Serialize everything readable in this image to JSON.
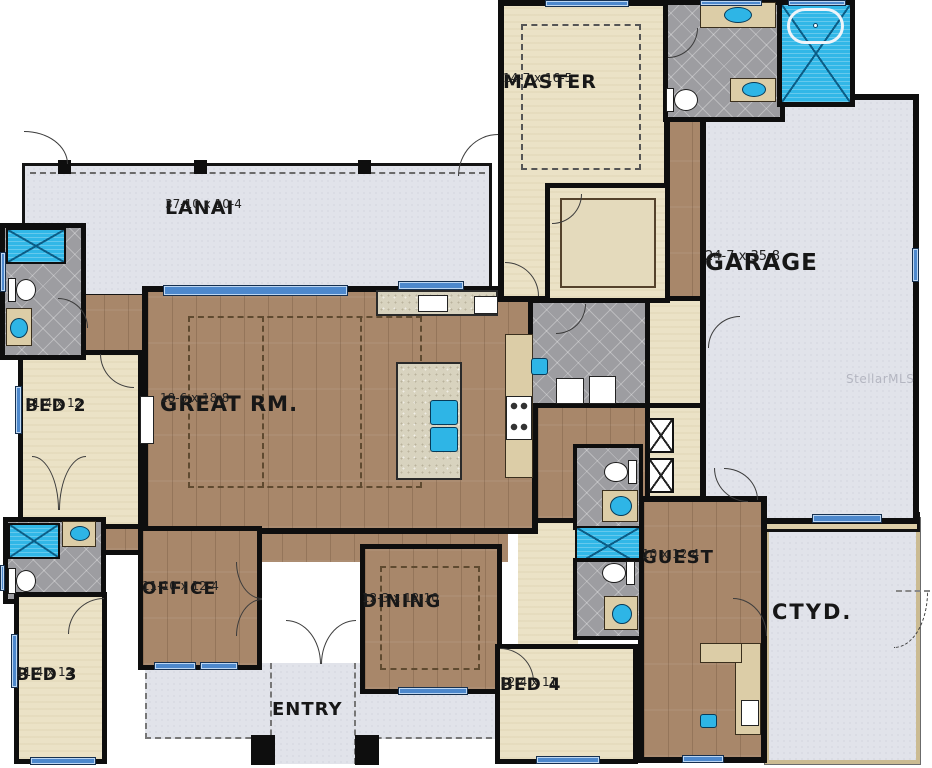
{
  "title": "Single-story house floor plan",
  "watermark": "StellarMLS",
  "palette": {
    "wall": "#0e0e0e",
    "carpet": "#ebe2c6",
    "wood_floor": "#a8876a",
    "tile": "#9d9da1",
    "outdoor_concrete": "#e1e3ea",
    "fixture_blue": "#31b7e7",
    "window_blue": "#4d88cc",
    "counter_tan": "#dccda7"
  },
  "rooms": {
    "lanai": {
      "name": "LANAI",
      "dims": "37-10 x 10-4"
    },
    "master": {
      "name": "MASTER",
      "dims": "14-7 x 16-5"
    },
    "garage": {
      "name": "GARAGE",
      "dims": "24-7 x 35-8"
    },
    "great": {
      "name": "GREAT RM.",
      "dims": "18-6 x 18-8"
    },
    "bed2": {
      "name": "BED 2",
      "dims": "11-4 x 12"
    },
    "bed3": {
      "name": "BED 3",
      "dims": "11-4 x 12"
    },
    "bed4": {
      "name": "BED 4",
      "dims": "12-4 x 11"
    },
    "office": {
      "name": "OFFICE",
      "dims": "11-10 x 12-4"
    },
    "dining": {
      "name": "DINING",
      "dims": "12-3 x 12-10"
    },
    "guest": {
      "name": "GUEST",
      "dims": "10 x 12-4"
    },
    "entry": {
      "name": "ENTRY"
    },
    "ctyd": {
      "name": "CTYD."
    }
  }
}
